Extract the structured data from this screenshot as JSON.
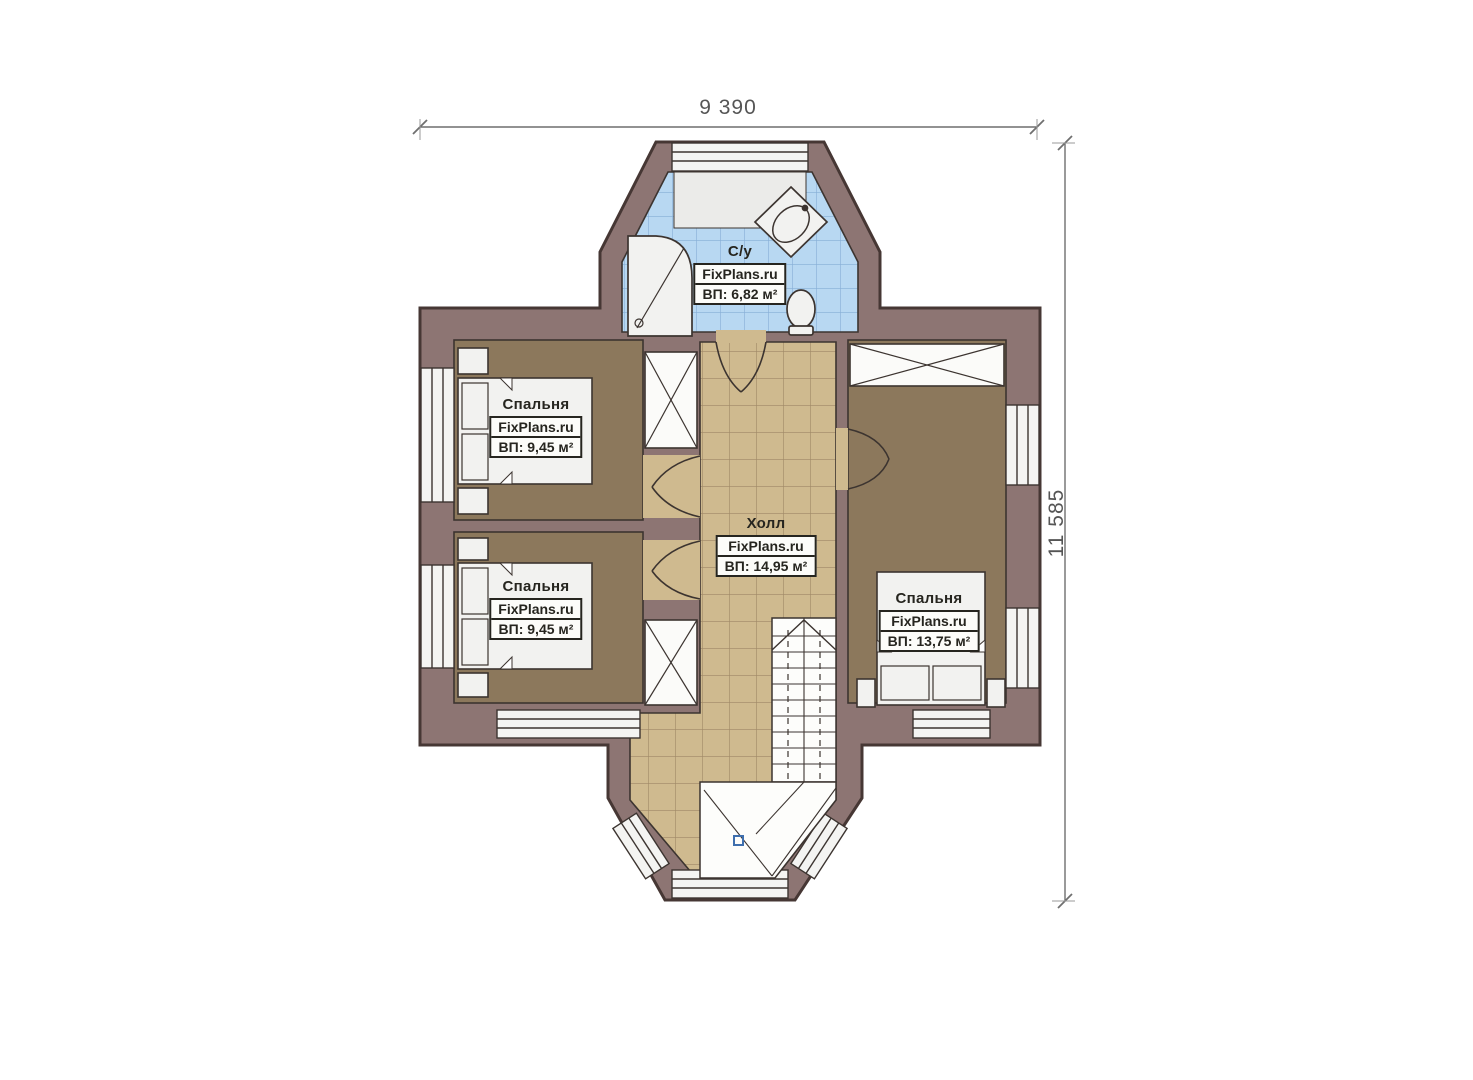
{
  "plan_title": "floor-plan-second-level",
  "dimensions": {
    "width_label": "9 390",
    "height_label": "11 585"
  },
  "rooms": {
    "bathroom": {
      "name": "С/у",
      "brand": "FixPlans.ru",
      "area": "ВП: 6,82 м²"
    },
    "bedroom_top_left": {
      "name": "Спальня",
      "brand": "FixPlans.ru",
      "area": "ВП: 9,45 м²"
    },
    "bedroom_bottom_left": {
      "name": "Спальня",
      "brand": "FixPlans.ru",
      "area": "ВП: 9,45 м²"
    },
    "hall": {
      "name": "Холл",
      "brand": "FixPlans.ru",
      "area": "ВП: 14,95 м²"
    },
    "bedroom_right": {
      "name": "Спальня",
      "brand": "FixPlans.ru",
      "area": "ВП: 13,75 м²"
    }
  },
  "colors": {
    "wall": "#8d7573",
    "wall-edge": "#463734",
    "line": "#3c3430",
    "bedroom-floor": "#8c785c",
    "hall-floor": "#cfba8f",
    "hall-grid": "#9f8866",
    "bath-floor": "#b8d8f2",
    "bath-grid": "#86aed6",
    "fixture": "#f2f2f0",
    "window": "#f4f4f2",
    "label-text": "#26251f",
    "dim-text": "#555555",
    "marker-blue": "#3f6fae"
  }
}
